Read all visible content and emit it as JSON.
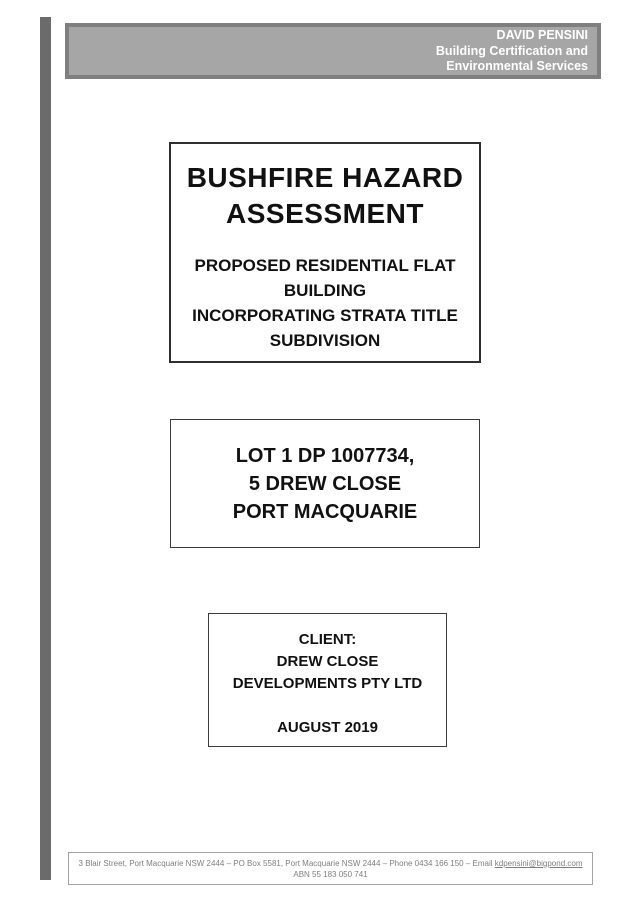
{
  "accent_bar_color": "#6b6b6b",
  "header": {
    "company_name": "DAVID PENSINI",
    "tagline_line1": "Building Certification and",
    "tagline_line2": "Environmental Services",
    "background_color": "#a6a6a6",
    "border_color": "#7f7f7f",
    "text_color": "#ffffff"
  },
  "title_box": {
    "title_line1": "BUSHFIRE HAZARD",
    "title_line2": "ASSESSMENT",
    "subtitle_lines": [
      "PROPOSED RESIDENTIAL FLAT",
      "BUILDING",
      "INCORPORATING STRATA TITLE",
      "SUBDIVISION"
    ]
  },
  "property_box": {
    "lines": [
      "LOT 1 DP 1007734,",
      "5 DREW CLOSE",
      "PORT MACQUARIE"
    ]
  },
  "client_box": {
    "label": "CLIENT:",
    "client_line1": "DREW CLOSE",
    "client_line2": "DEVELOPMENTS PTY LTD",
    "date": "AUGUST 2019"
  },
  "footer": {
    "contact_prefix": "3 Blair Street, Port Macquarie NSW 2444 – PO Box 5581, Port Macquarie NSW 2444 – Phone 0434 166 150 – Email ",
    "email": "kdpensini@bigpond.com",
    "abn": "ABN 55 183 050 741",
    "text_color": "#7f7f7f"
  }
}
